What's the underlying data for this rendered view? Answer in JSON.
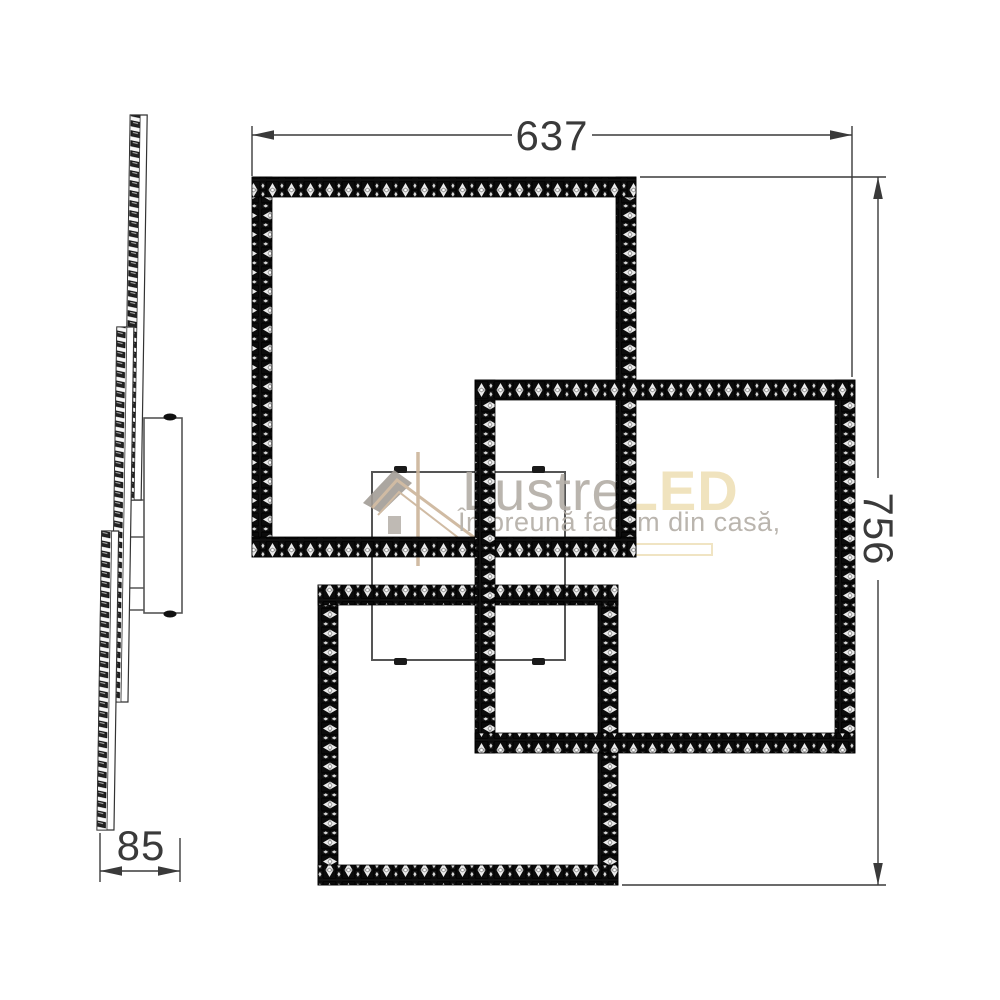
{
  "drawing": {
    "type": "product dimension diagram (LED ceiling lamp, 3 crystal square frames)",
    "dimensions": {
      "width": {
        "value": "637"
      },
      "height": {
        "value": "756"
      },
      "depth": {
        "value": "85"
      }
    }
  },
  "watermark": {
    "icon": "house-icon",
    "brand_primary": "Lustre",
    "brand_accent": "LED",
    "tagline": "Împreună facem din casă,",
    "accent_color": "#efe0b8",
    "gray_color": "#b3ada6"
  },
  "colors": {
    "dimension_line": "#3a3a3a",
    "crystal_dark": "#101010",
    "plate_line": "#555555"
  }
}
